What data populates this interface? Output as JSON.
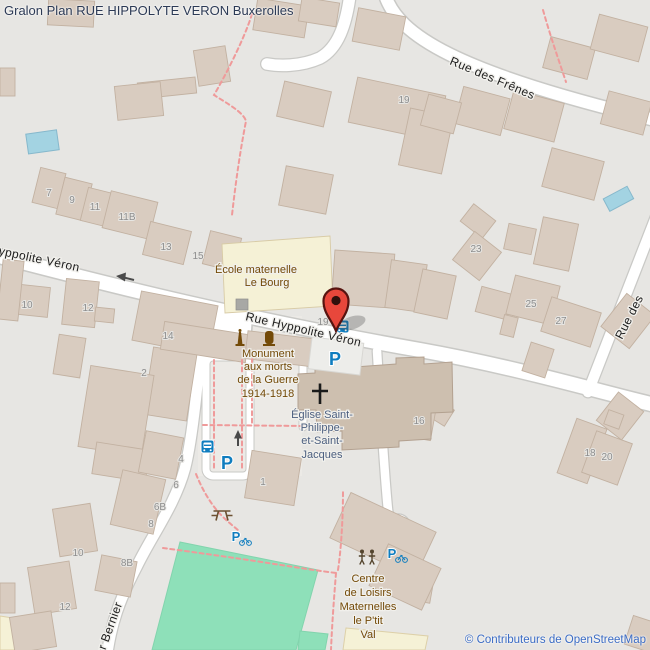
{
  "title": "Gralon Plan RUE HIPPOLYTE VERON Buxerolles",
  "attribution": "© Contributeurs de OpenStreetMap",
  "streets": {
    "rue_des_frenes": "Rue des Frênes",
    "rue_hyppolite_veron_center": "Rue Hyppolite Véron",
    "rue_hyppolite_veron_left": "Rue Hyppolite Véron",
    "rue_des_partial": "Rue des",
    "rue_bernier_partial": "er Bernier"
  },
  "places": {
    "ecole": {
      "lines": [
        "École maternelle",
        "Le Bourg"
      ]
    },
    "monument": {
      "lines": [
        "Monument",
        "aux morts",
        "de la Guerre",
        "1914-1918"
      ]
    },
    "eglise": {
      "lines": [
        "Église Saint-",
        "Philippe-",
        "et-Saint-",
        "Jacques"
      ]
    },
    "centre_loisirs": {
      "lines": [
        "Centre",
        "de Loisirs",
        "Maternelles",
        "le P'tit",
        "Val"
      ]
    }
  },
  "house_numbers": [
    {
      "v": "7"
    },
    {
      "v": "9"
    },
    {
      "v": "11"
    },
    {
      "v": "11B"
    },
    {
      "v": "13"
    },
    {
      "v": "15"
    },
    {
      "v": "19"
    },
    {
      "v": "23"
    },
    {
      "v": "25"
    },
    {
      "v": "27"
    },
    {
      "v": "14"
    },
    {
      "v": "2"
    },
    {
      "v": "10"
    },
    {
      "v": "12"
    },
    {
      "v": "19"
    },
    {
      "v": "16"
    },
    {
      "v": "18"
    },
    {
      "v": "20"
    },
    {
      "v": "4"
    },
    {
      "v": "6"
    },
    {
      "v": "6B"
    },
    {
      "v": "8"
    },
    {
      "v": "10"
    },
    {
      "v": "8B"
    },
    {
      "v": "12"
    },
    {
      "v": "1"
    }
  ],
  "icons": {
    "parking_label": "P",
    "bus_stop": "bus-stop",
    "bicycle_parking": "parking-with-bicycle",
    "playground": "playground-figures",
    "picnic": "picnic-table",
    "memorial": "memorial-obelisk",
    "christian_cross": "christian-cross",
    "marker": "red-map-pin"
  },
  "colors": {
    "background": "#e7e6e3",
    "building": "#d9ccc0",
    "building_outline": "#c2b1a1",
    "church_building": "#cdbfaf",
    "school_building": "#f5f1d6",
    "road": "#ffffff",
    "road_casing": "#c9c9c6",
    "pitch_green": "#8ee0b9",
    "water_blue": "#a3d3e2",
    "footpath_pink": "#ef9a9a",
    "parking_blue": "#0f7dbf",
    "marker_red": "#e8473b",
    "label_brown": "#734a08",
    "label_church_blue": "#4d6080",
    "housenumber_gray": "#8d8d8d",
    "title_color": "#2c3a55",
    "attribution_color": "#3a6bc4"
  }
}
